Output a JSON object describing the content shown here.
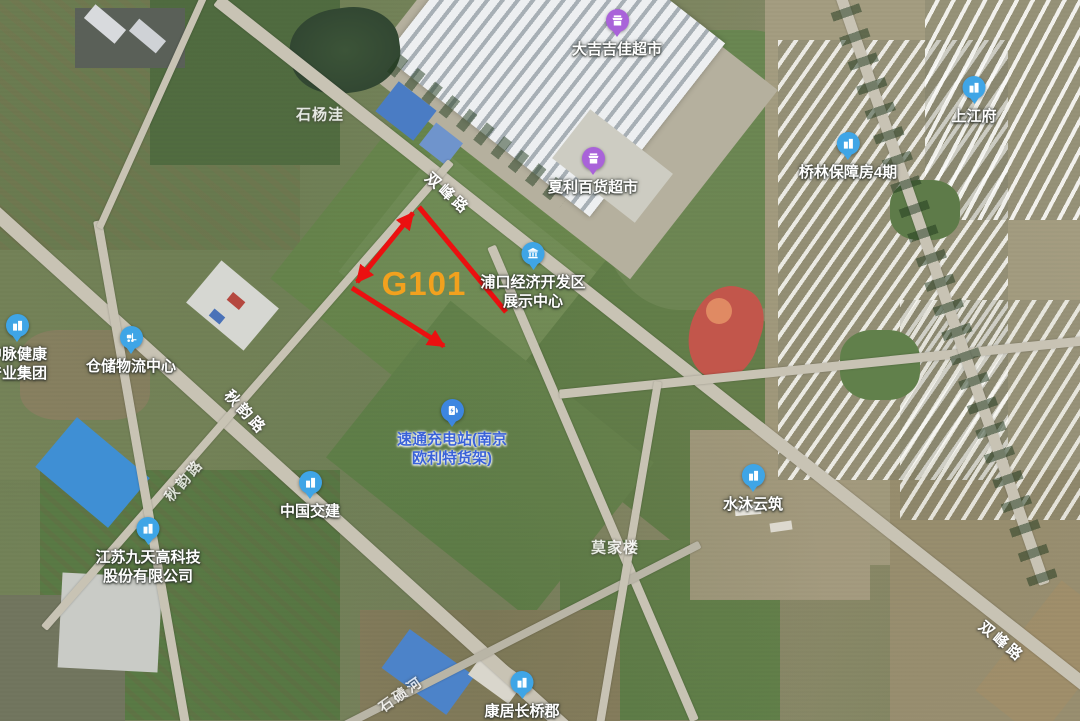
{
  "map_colors": {
    "pin_blue": "#3FA5E6",
    "pin_purple": "#A963D9",
    "pin_charger": "#3D86E0",
    "annotation_red": "#EB1010",
    "parcel_text_orange": "#F2A11E",
    "charging_label_blue": "#3A62D8",
    "road_fill": "#C8C3B4"
  },
  "annotation": {
    "parcel_id": "G101"
  },
  "pois": [
    {
      "id": "dajijiajia-supermarket",
      "icon": "store-icon",
      "label": "大吉吉佳超市"
    },
    {
      "id": "xiali-department-store",
      "icon": "store-icon",
      "label": "夏利百货超市"
    },
    {
      "id": "pukou-exhibition-center",
      "icon": "exhibition-hall-icon",
      "line1": "浦口经济开发区",
      "line2": "展示中心"
    },
    {
      "id": "shangjiangfu",
      "icon": "building-icon",
      "label": "上江府"
    },
    {
      "id": "qiaolin-housing-phase4",
      "icon": "building-icon",
      "label": "桥林保障房4期"
    },
    {
      "id": "zhongmai-health-group",
      "icon": "building-icon",
      "line1": "中脉健康",
      "line2": "产业集团"
    },
    {
      "id": "warehouse-logistics-center",
      "icon": "forklift-icon",
      "label": "仓储物流中心"
    },
    {
      "id": "sutong-charging-station",
      "icon": "charging-station-icon",
      "line1": "速通充电站(南京",
      "line2": "欧利特货架)"
    },
    {
      "id": "china-communications-construction",
      "icon": "building-icon",
      "label": "中国交建"
    },
    {
      "id": "jiangsu-jiutian-hitech",
      "icon": "building-icon",
      "line1": "江苏九天高科技",
      "line2": "股份有限公司"
    },
    {
      "id": "shuimu-yunzhu",
      "icon": "building-icon",
      "label": "水沐云筑"
    },
    {
      "id": "kangju-changqiaojun",
      "icon": "building-icon",
      "label": "康居长桥郡"
    }
  ],
  "road_labels": [
    {
      "text": "双峰路"
    },
    {
      "text": "秋韵路"
    },
    {
      "text": "秋韵路"
    },
    {
      "text": "双峰路"
    },
    {
      "text": "石碛河"
    }
  ],
  "area_labels": [
    {
      "text": "石杨洼"
    },
    {
      "text": "莫家楼"
    }
  ]
}
